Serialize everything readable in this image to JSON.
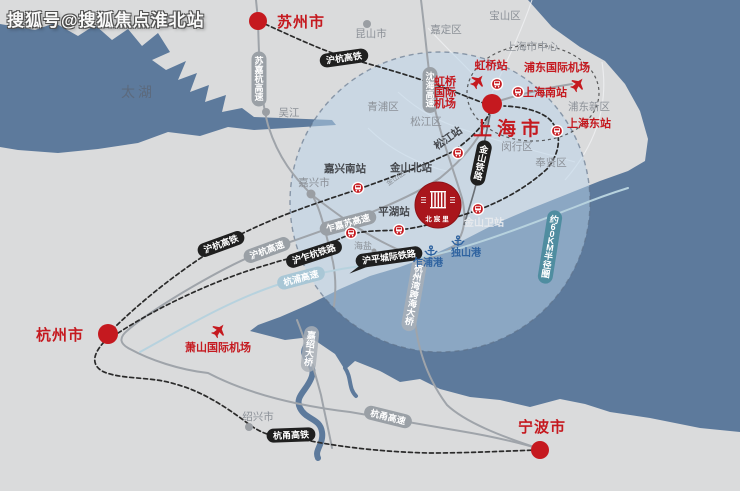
{
  "watermark": "搜狐号@搜狐焦点淮北站",
  "project": {
    "name": "北宸里"
  },
  "colors": {
    "land": "#dadbdc",
    "water": "#5d7a9c",
    "circle_fill": "#b9d4ea",
    "accent_red": "#c5191f",
    "project_red": "#a9161c",
    "pill_black": "#1f1f1f",
    "pill_gray": "#9aa0a6",
    "pill_teal": "#a9c7d6",
    "pill_teal_dark": "#4f8da0",
    "pill_bridge": "#aab0b7",
    "port_blue": "#2f63a0",
    "district_gray": "#8b9097",
    "station_dark": "#45484d",
    "lake_label": "#5c6a7d"
  },
  "map": {
    "labels": [
      {
        "id": "label-taihu-lake",
        "text": "太湖",
        "cls": "lake",
        "x": 138,
        "y": 97
      },
      {
        "id": "label-suzhou-city",
        "text": "苏州市",
        "cls": "city",
        "x": 301,
        "y": 27
      },
      {
        "id": "label-kunshan-city",
        "text": "昆山市",
        "cls": "district",
        "x": 371,
        "y": 37
      },
      {
        "id": "label-wujiang",
        "text": "吴江",
        "cls": "district",
        "x": 289,
        "y": 116
      },
      {
        "id": "label-jiading-district",
        "text": "嘉定区",
        "cls": "district",
        "x": 446,
        "y": 33
      },
      {
        "id": "label-baoshan-district",
        "text": "宝山区",
        "cls": "district",
        "x": 505,
        "y": 19
      },
      {
        "id": "label-shanghai-center",
        "text": "上海市中心",
        "cls": "district",
        "x": 532,
        "y": 50
      },
      {
        "id": "label-qingpu-district",
        "text": "青浦区",
        "cls": "district",
        "x": 383,
        "y": 110
      },
      {
        "id": "label-songjiang-district",
        "text": "松江区",
        "cls": "district",
        "x": 426,
        "y": 125
      },
      {
        "id": "label-minhang-district",
        "text": "闵行区",
        "cls": "district",
        "x": 517,
        "y": 150
      },
      {
        "id": "label-fengxian-district",
        "text": "奉贤区",
        "cls": "district",
        "x": 551,
        "y": 166
      },
      {
        "id": "label-pudong-new-district",
        "text": "浦东新区",
        "cls": "district",
        "x": 589,
        "y": 110
      },
      {
        "id": "label-jiaxing-city",
        "text": "嘉兴市",
        "cls": "district",
        "x": 314,
        "y": 186
      },
      {
        "id": "label-haiyan",
        "text": "海盐",
        "cls": "district-sm",
        "x": 363,
        "y": 249
      },
      {
        "id": "label-shaoxing-city",
        "text": "绍兴市",
        "cls": "district",
        "x": 258,
        "y": 420
      },
      {
        "id": "label-hongqiao-station",
        "text": "虹桥站",
        "cls": "station-red",
        "x": 491,
        "y": 69
      },
      {
        "id": "label-pudong-airport",
        "text": "浦东国际机场",
        "cls": "station-red",
        "x": 557,
        "y": 71
      },
      {
        "id": "label-hongqiao-airport-line1",
        "text": "虹桥",
        "cls": "station-red",
        "x": 445,
        "y": 85
      },
      {
        "id": "label-hongqiao-airport-line2",
        "text": "国际",
        "cls": "station-red",
        "x": 445,
        "y": 96
      },
      {
        "id": "label-hongqiao-airport-line3",
        "text": "机场",
        "cls": "station-red",
        "x": 445,
        "y": 107
      },
      {
        "id": "label-shanghai-south-station",
        "text": "上海南站",
        "cls": "station-red",
        "x": 545,
        "y": 96
      },
      {
        "id": "label-shanghai-east-station",
        "text": "上海东站",
        "cls": "station-red",
        "x": 589,
        "y": 127
      },
      {
        "id": "label-shanghai-city",
        "text": "上海市",
        "cls": "city-big",
        "x": 509,
        "y": 135
      },
      {
        "id": "label-songjiang-station",
        "text": "松江站",
        "cls": "station-dark",
        "x": 450,
        "y": 141,
        "rot": -35
      },
      {
        "id": "label-jiaxing-south-station",
        "text": "嘉兴南站",
        "cls": "station-dark",
        "x": 345,
        "y": 172
      },
      {
        "id": "label-jinshan-north-station",
        "text": "金山北站",
        "cls": "station-dark",
        "x": 411,
        "y": 171
      },
      {
        "id": "label-pinghu-station",
        "text": "平湖站",
        "cls": "station-dark",
        "x": 394,
        "y": 215
      },
      {
        "id": "label-jinshanwei-station",
        "text": "金山卫站",
        "cls": "station-light",
        "x": 484,
        "y": 226
      },
      {
        "id": "label-jinshan-district",
        "text": "金山区",
        "cls": "tiny",
        "x": 397,
        "y": 180,
        "rot": -35
      },
      {
        "id": "label-zhapu-port",
        "text": "乍浦港",
        "cls": "port",
        "x": 428,
        "y": 266
      },
      {
        "id": "label-dushan-port",
        "text": "独山港",
        "cls": "port",
        "x": 466,
        "y": 256
      },
      {
        "id": "label-hangzhou-city",
        "text": "杭州市",
        "cls": "city",
        "x": 60,
        "y": 340
      },
      {
        "id": "label-xiaoshan-airport",
        "text": "萧山国际机场",
        "cls": "station-red",
        "x": 218,
        "y": 351
      },
      {
        "id": "label-ningbo-city",
        "text": "宁波市",
        "cls": "city",
        "x": 542,
        "y": 432
      }
    ],
    "pills": [
      {
        "id": "pill-huhang-hsr-north",
        "text": "沪杭高铁",
        "variant": "black",
        "cx": 344,
        "cy": 58,
        "rot": -8
      },
      {
        "id": "pill-sujiahang-expressway",
        "text": "苏嘉杭高速",
        "variant": "gray",
        "cx": 259,
        "cy": 79,
        "vertical": true
      },
      {
        "id": "pill-shenhai-expressway",
        "text": "沈海高速",
        "variant": "gray",
        "cx": 430,
        "cy": 90,
        "vertical": true
      },
      {
        "id": "pill-jinshan-railway",
        "text": "金山铁路",
        "variant": "black",
        "cx": 481,
        "cy": 163,
        "vertical": true,
        "rot": 12
      },
      {
        "id": "pill-zhajiasu-expressway",
        "text": "乍嘉苏高速",
        "variant": "gray",
        "cx": 348,
        "cy": 223,
        "rot": -15
      },
      {
        "id": "pill-huhang-hsr-south",
        "text": "沪杭高铁",
        "variant": "black",
        "cx": 221,
        "cy": 244,
        "rot": -20
      },
      {
        "id": "pill-huhang-expressway",
        "text": "沪杭高速",
        "variant": "gray",
        "cx": 267,
        "cy": 250,
        "rot": -20
      },
      {
        "id": "pill-huzhahang-railway",
        "text": "沪乍杭铁路",
        "variant": "black",
        "cx": 314,
        "cy": 254,
        "rot": -18
      },
      {
        "id": "pill-hangpu-expressway",
        "text": "杭浦高速",
        "variant": "teal",
        "cx": 301,
        "cy": 278,
        "rot": -15
      },
      {
        "id": "pill-huping-intercity-railway",
        "text": "沪平城际铁路",
        "variant": "black",
        "cx": 389,
        "cy": 257,
        "rot": -8,
        "tail": true
      },
      {
        "id": "pill-hangzhou-bay-bridge",
        "text": "杭州湾跨海大桥",
        "variant": "bridge",
        "cx": 414,
        "cy": 295,
        "vertical": true,
        "rot": 10
      },
      {
        "id": "pill-jiashao-bridge",
        "text": "嘉绍大桥",
        "variant": "bridge",
        "cx": 310,
        "cy": 349,
        "vertical": true,
        "rot": 6
      },
      {
        "id": "pill-hangyong-hsr",
        "text": "杭甬高铁",
        "variant": "black",
        "cx": 291,
        "cy": 435,
        "rot": -2
      },
      {
        "id": "pill-hangyong-expressway",
        "text": "杭甬高速",
        "variant": "gray",
        "cx": 388,
        "cy": 417,
        "rot": 14
      },
      {
        "id": "pill-60km-radius",
        "text": "约60KM半径圈",
        "variant": "teal-dark",
        "cx": 550,
        "cy": 247,
        "vertical": true,
        "rot": 9
      }
    ],
    "station_icons": [
      {
        "id": "station-icon-hongqiao",
        "x": 497,
        "y": 84
      },
      {
        "id": "station-icon-shanghai-south",
        "x": 518,
        "y": 92
      },
      {
        "id": "station-icon-shanghai-east",
        "x": 557,
        "y": 131
      },
      {
        "id": "station-icon-songjiang",
        "x": 458,
        "y": 153
      },
      {
        "id": "station-icon-jiaxing-south",
        "x": 358,
        "y": 188
      },
      {
        "id": "station-icon-jinshanwei",
        "x": 478,
        "y": 209
      },
      {
        "id": "station-icon-haiyan-line",
        "x": 351,
        "y": 233
      },
      {
        "id": "station-icon-pinghu",
        "x": 399,
        "y": 230
      }
    ],
    "plane_icons": [
      {
        "id": "hongqiao-airport-plane-icon",
        "x": 478,
        "y": 81
      },
      {
        "id": "pudong-airport-plane-icon",
        "x": 578,
        "y": 84
      },
      {
        "id": "xiaoshan-airport-plane-icon",
        "x": 219,
        "y": 330
      }
    ],
    "anchor_icons": [
      {
        "id": "zhapu-port-anchor-icon",
        "x": 431,
        "y": 251
      },
      {
        "id": "dushan-port-anchor-icon",
        "x": 458,
        "y": 241
      }
    ],
    "city_dots": [
      {
        "id": "suzhou-dot",
        "x": 258,
        "y": 21,
        "r": 9
      },
      {
        "id": "shanghai-dot",
        "x": 492,
        "y": 104,
        "r": 10
      },
      {
        "id": "hangzhou-dot",
        "x": 108,
        "y": 334,
        "r": 10
      },
      {
        "id": "ningbo-dot",
        "x": 540,
        "y": 450,
        "r": 9
      }
    ],
    "town_dots": [
      {
        "id": "kunshan-dot",
        "x": 367,
        "y": 24,
        "r": 4
      },
      {
        "id": "wujiang-dot",
        "x": 266,
        "y": 112,
        "r": 4
      },
      {
        "id": "jiaxing-dot",
        "x": 311,
        "y": 194,
        "r": 4.5
      },
      {
        "id": "shaoxing-dot",
        "x": 249,
        "y": 427,
        "r": 4
      },
      {
        "id": "haiyan-dot",
        "x": 374,
        "y": 251,
        "r": 2.5
      }
    ]
  }
}
